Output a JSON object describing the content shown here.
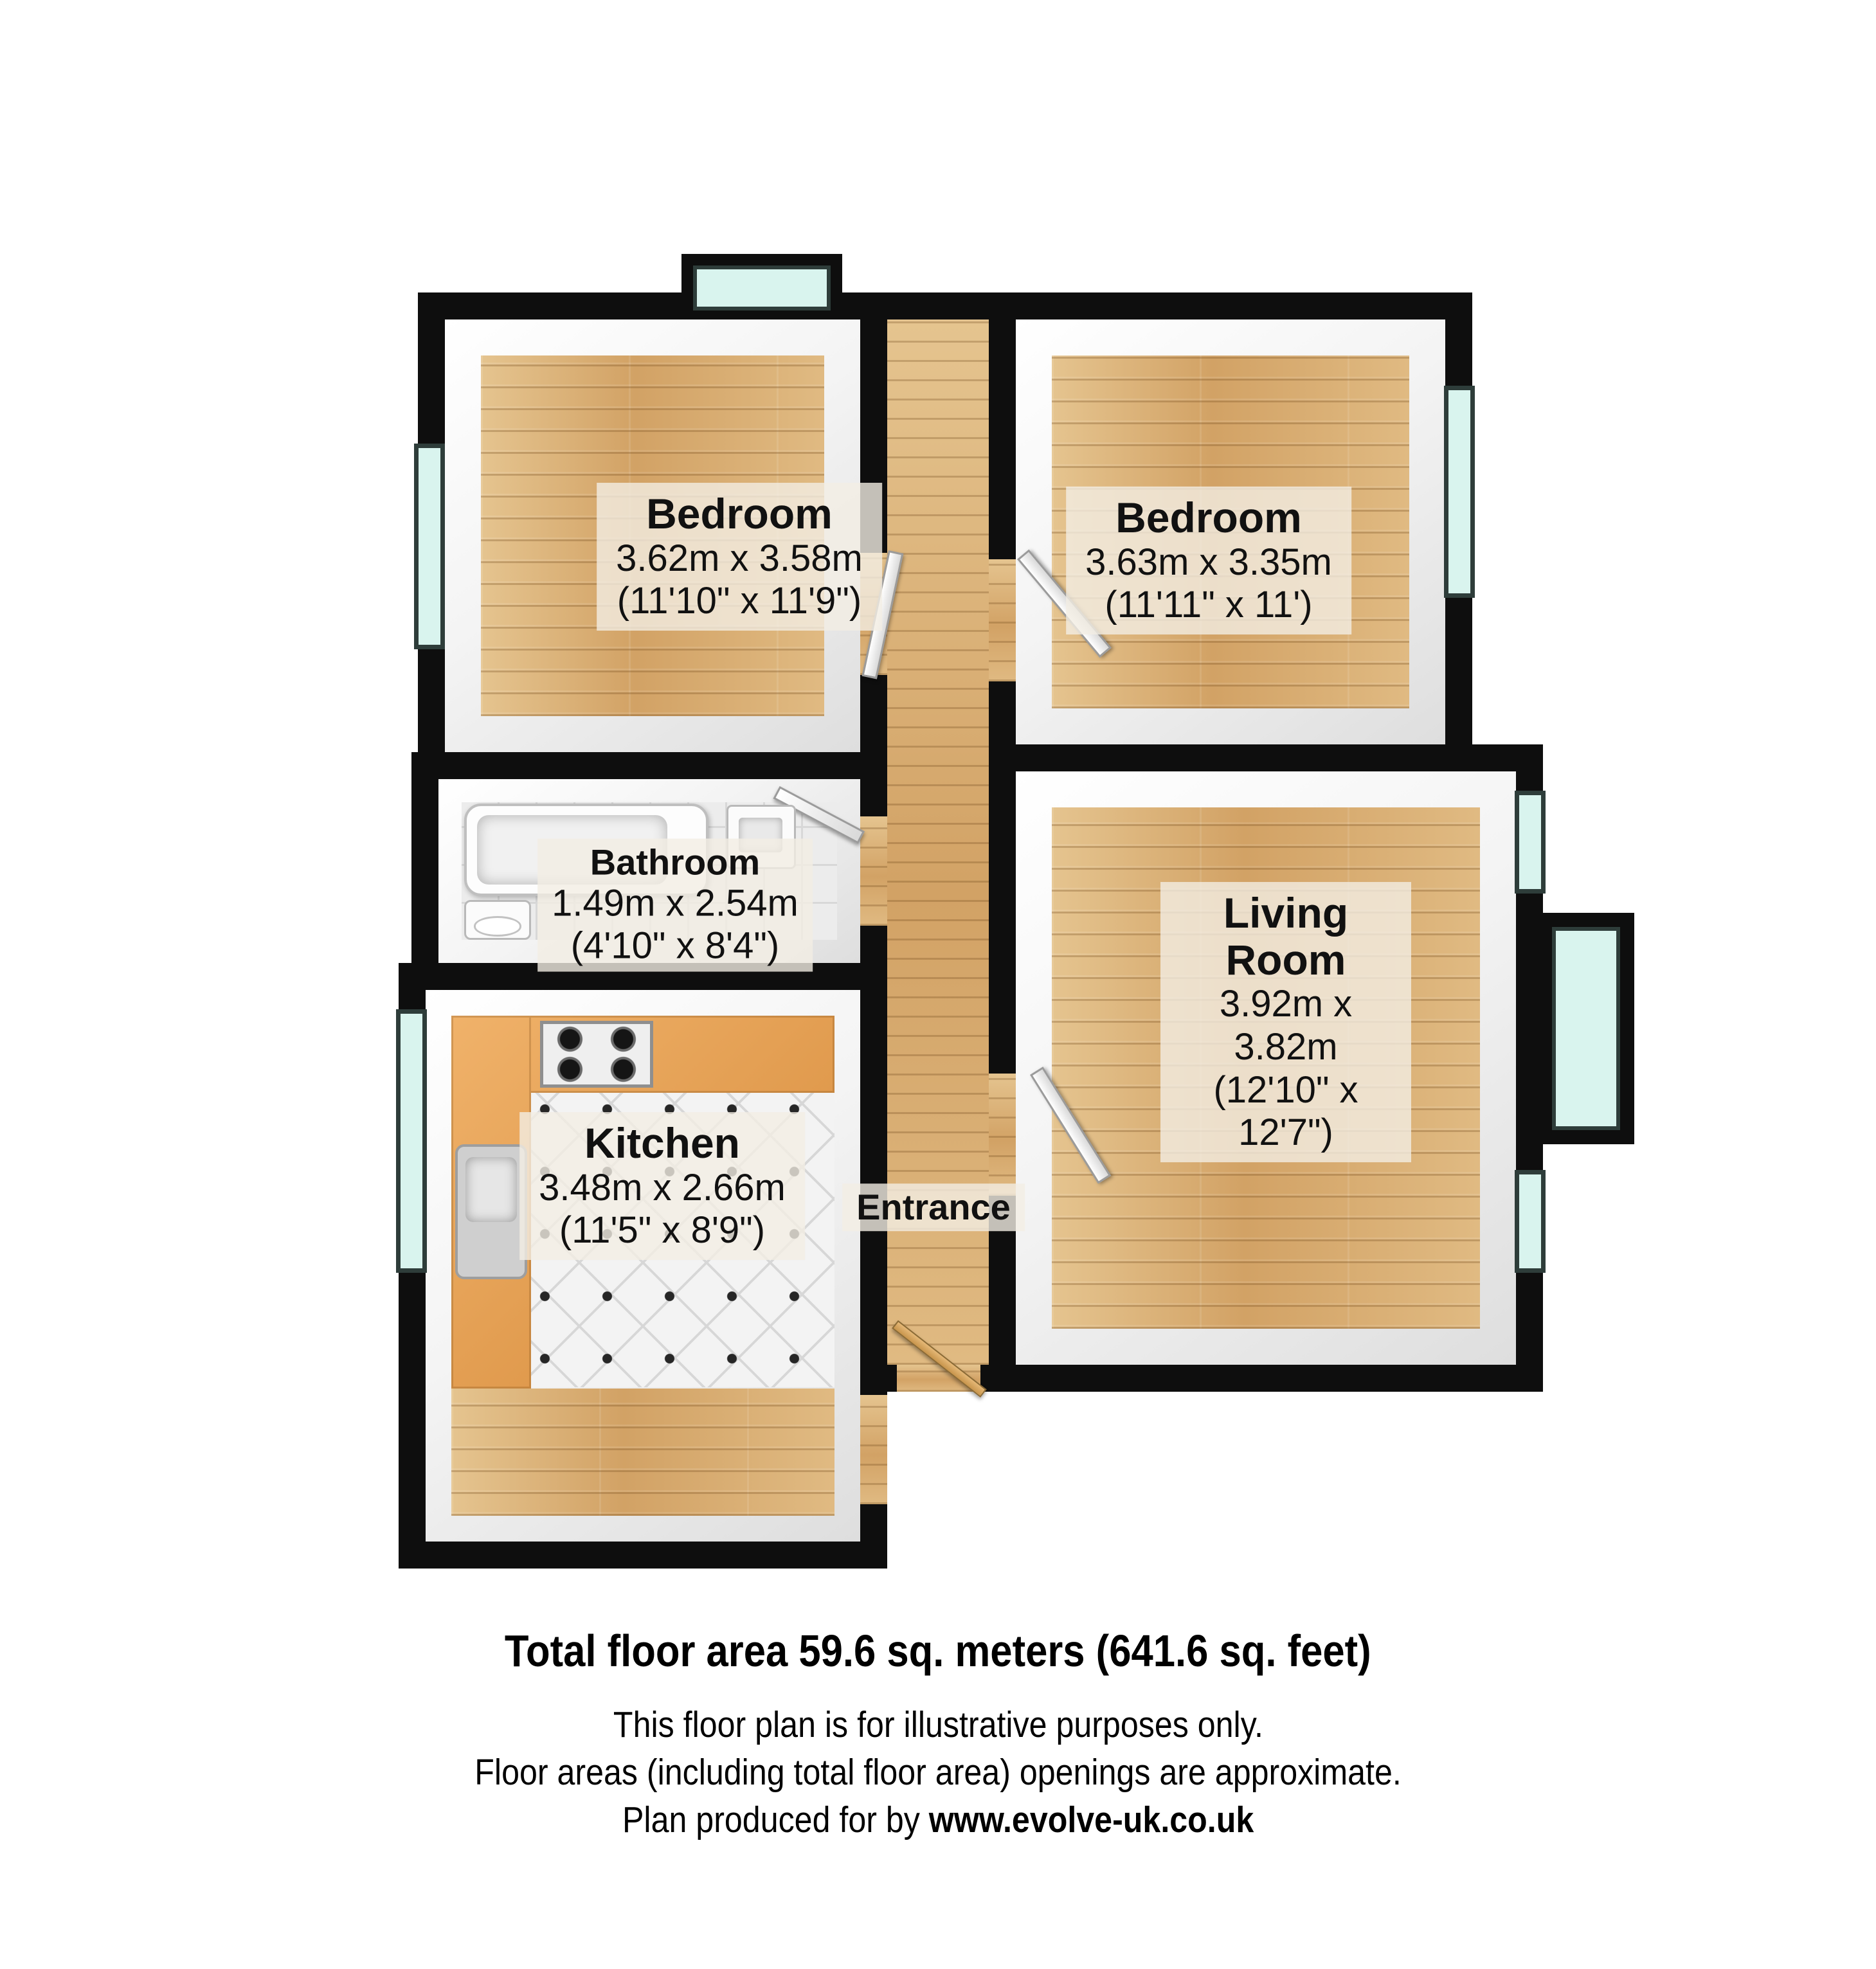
{
  "plan": {
    "rooms": {
      "bedroom_left": {
        "name": "Bedroom",
        "size_metric": "3.62m x 3.58m",
        "size_imperial": "(11'10\" x 11'9\")"
      },
      "bedroom_right": {
        "name": "Bedroom",
        "size_metric": "3.63m x 3.35m",
        "size_imperial": "(11'11\" x 11')"
      },
      "bathroom": {
        "name": "Bathroom",
        "size_metric": "1.49m x 2.54m",
        "size_imperial": "(4'10\" x 8'4\")"
      },
      "kitchen": {
        "name": "Kitchen",
        "size_metric": "3.48m x 2.66m",
        "size_imperial": "(11'5\" x 8'9\")"
      },
      "living_room": {
        "name": "Living Room",
        "size_metric": "3.92m x 3.82m",
        "size_imperial": "(12'10\" x 12'7\")"
      },
      "entrance": {
        "name": "Entrance"
      }
    },
    "colors": {
      "wall": "#0e0e0e",
      "wood_floor": "#d9b27a",
      "window_glass": "#d9f4ee",
      "kitchen_counter": "#e8a55c",
      "label_background": "#f3eee4"
    }
  },
  "footer": {
    "total_area": "Total floor area 59.6 sq. meters (641.6 sq. feet)",
    "disclaimer1": "This floor plan is for illustrative purposes only.",
    "disclaimer2": "Floor areas (including total floor area) openings are approximate.",
    "produced_prefix": "Plan produced for by ",
    "produced_site": "www.evolve-uk.co.uk"
  }
}
